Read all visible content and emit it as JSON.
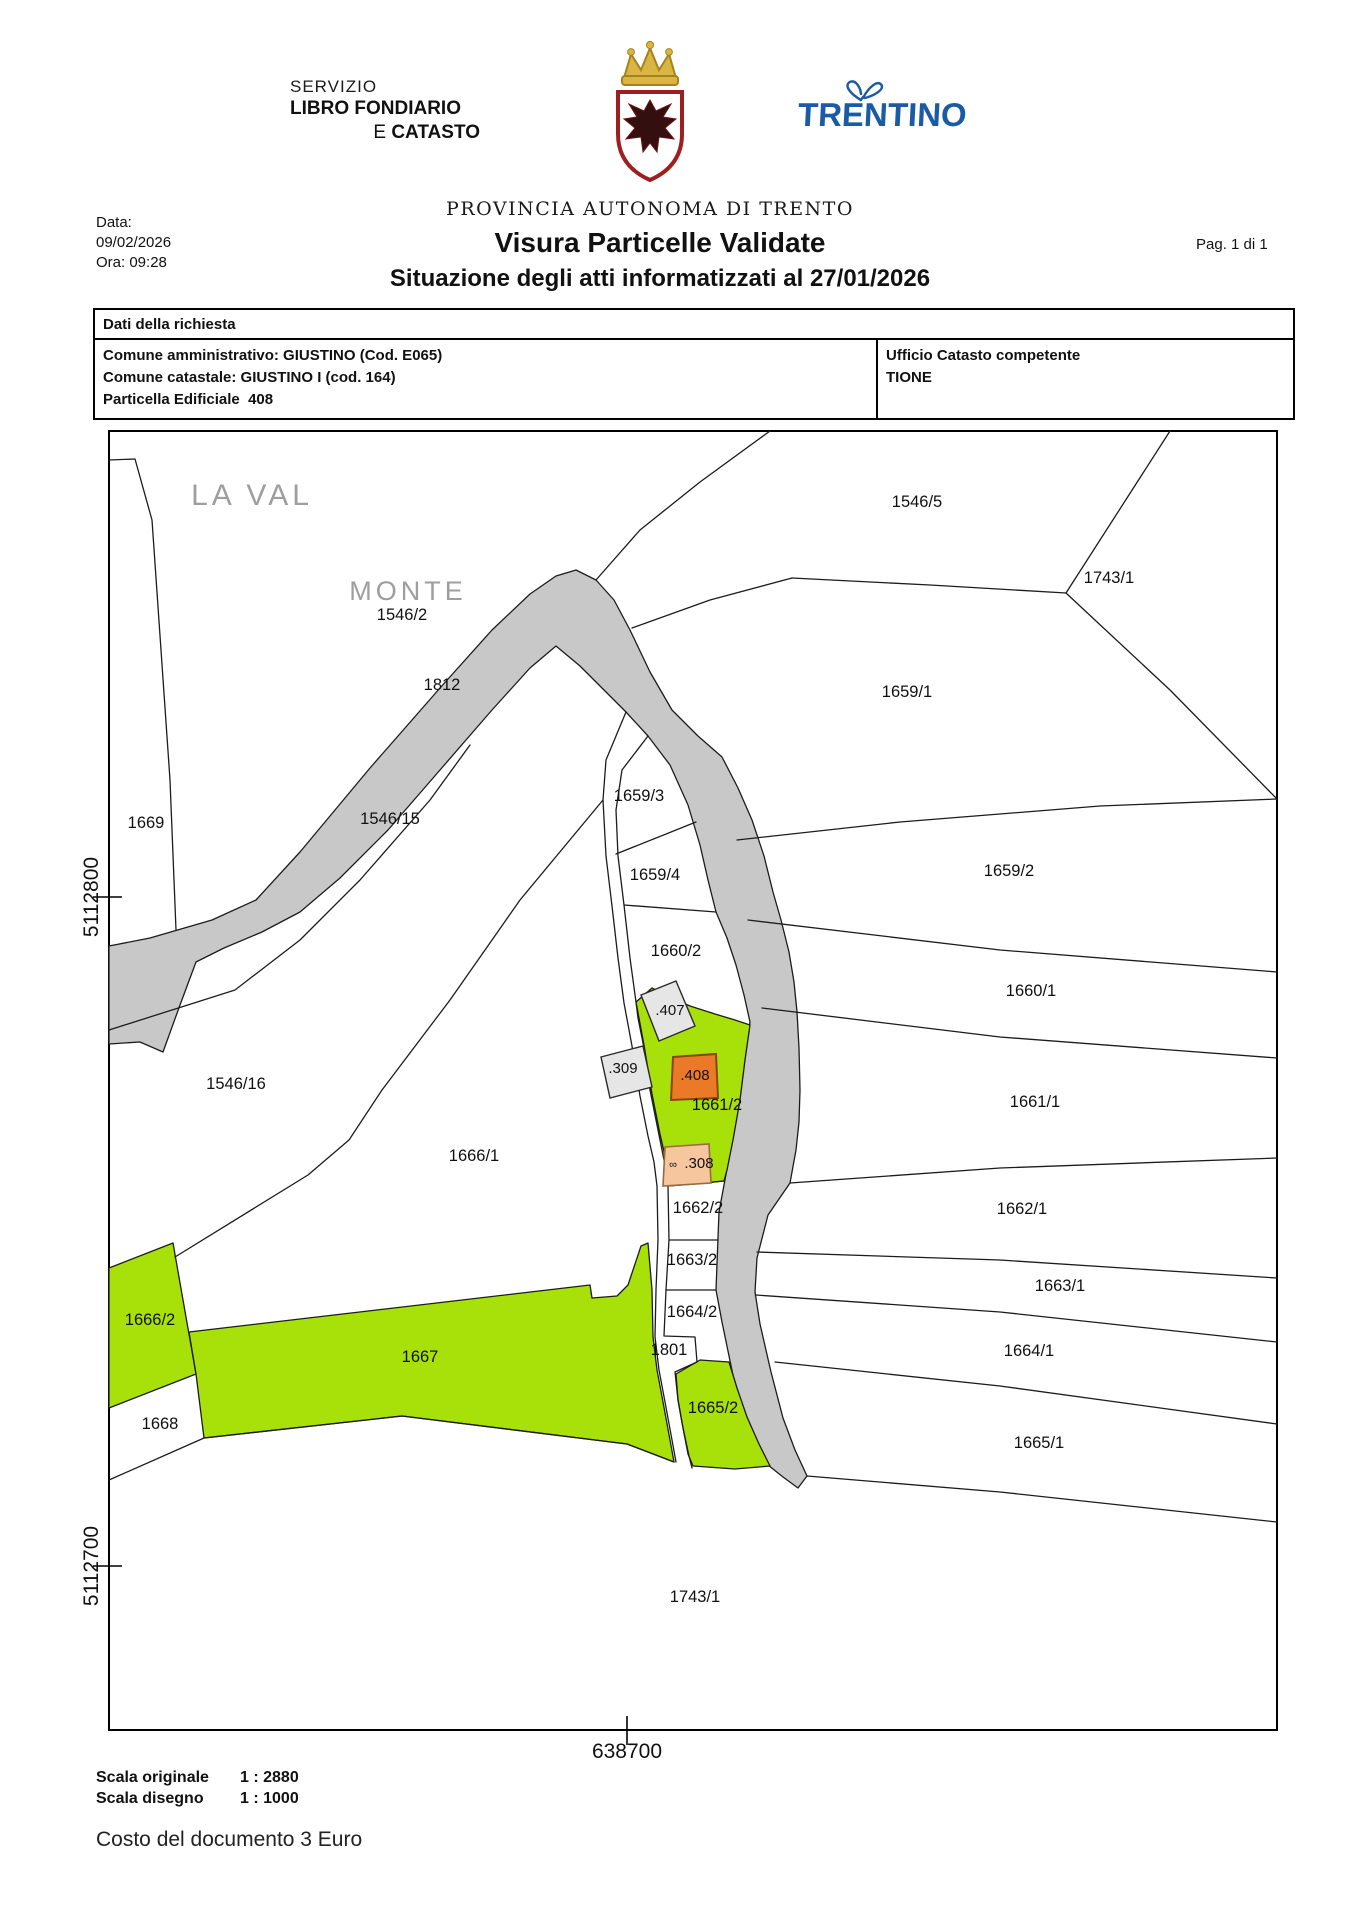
{
  "header": {
    "service_line1": "SERVIZIO",
    "service_line2": "LIBRO FONDIARIO",
    "service_line3_prefix": "E ",
    "service_line3": "CATASTO",
    "province": "PROVINCIA AUTONOMA DI TRENTO",
    "trentino_logo": "TRENTINO",
    "crest_icon": "trento-eagle-crest",
    "butterfly_icon": "butterfly",
    "logo_blue": "#1b5ba6",
    "crest_red": "#9e1f1f",
    "crown_gold": "#d9b544"
  },
  "meta": {
    "date_label": "Data:",
    "date_value": "09/02/2026",
    "time_line": "Ora: 09:28",
    "title": "Visura Particelle Validate",
    "subtitle": "Situazione degli atti informatizzati al 27/01/2026",
    "page": "Pag. 1 di 1"
  },
  "request_table": {
    "header": "Dati della richiesta",
    "rows": [
      "Comune amministrativo: GIUSTINO (Cod. E065)",
      "Comune catastale: GIUSTINO I (cod. 164)",
      "Particella Edificiale  408"
    ],
    "office_label": "Ufficio Catasto competente",
    "office_value": "TIONE"
  },
  "map": {
    "colors": {
      "highlight_green": "#a8e00a",
      "selected_parcel_orange": "#ea7a28",
      "building_gray": "#e6e6e6",
      "building_peach": "#f6c69e",
      "road_gray": "#c8c8c8",
      "toponym_gray": "#9e9e9e"
    },
    "area_labels": [
      {
        "text": "LA VAL",
        "x": 252,
        "y": 505,
        "size": 30
      },
      {
        "text": "MONTE",
        "x": 408,
        "y": 600,
        "size": 27
      }
    ],
    "parcel_labels": [
      {
        "text": "1546/2",
        "x": 402,
        "y": 620
      },
      {
        "text": "1546/5",
        "x": 917,
        "y": 507
      },
      {
        "text": "1743/1",
        "x": 1109,
        "y": 583
      },
      {
        "text": "1659/1",
        "x": 907,
        "y": 697
      },
      {
        "text": "1812",
        "x": 442,
        "y": 690
      },
      {
        "text": "1669",
        "x": 146,
        "y": 828
      },
      {
        "text": "1546/15",
        "x": 390,
        "y": 824
      },
      {
        "text": "1659/3",
        "x": 639,
        "y": 801
      },
      {
        "text": "1659/4",
        "x": 655,
        "y": 880
      },
      {
        "text": "1659/2",
        "x": 1009,
        "y": 876
      },
      {
        "text": "1660/2",
        "x": 676,
        "y": 956
      },
      {
        "text": "1660/1",
        "x": 1031,
        "y": 996
      },
      {
        "text": ".407",
        "x": 670,
        "y": 1015,
        "small": true
      },
      {
        "text": ".309",
        "x": 623,
        "y": 1073,
        "small": true
      },
      {
        "text": ".408",
        "x": 695,
        "y": 1080,
        "small": true
      },
      {
        "text": "1661/2",
        "x": 717,
        "y": 1110
      },
      {
        "text": "1661/1",
        "x": 1035,
        "y": 1107
      },
      {
        "text": "1546/16",
        "x": 236,
        "y": 1089
      },
      {
        "text": "1666/1",
        "x": 474,
        "y": 1161
      },
      {
        "text": ".308",
        "x": 699,
        "y": 1168,
        "small": true
      },
      {
        "text": "1662/2",
        "x": 698,
        "y": 1213
      },
      {
        "text": "1662/1",
        "x": 1022,
        "y": 1214
      },
      {
        "text": "1663/2",
        "x": 692,
        "y": 1265
      },
      {
        "text": "1663/1",
        "x": 1060,
        "y": 1291
      },
      {
        "text": "1664/2",
        "x": 692,
        "y": 1317
      },
      {
        "text": "1664/1",
        "x": 1029,
        "y": 1356
      },
      {
        "text": "1801",
        "x": 669,
        "y": 1355
      },
      {
        "text": "1667",
        "x": 420,
        "y": 1362
      },
      {
        "text": "1666/2",
        "x": 150,
        "y": 1325
      },
      {
        "text": "1665/2",
        "x": 713,
        "y": 1413
      },
      {
        "text": "1668",
        "x": 160,
        "y": 1429
      },
      {
        "text": "1665/1",
        "x": 1039,
        "y": 1448
      },
      {
        "text": "1743/1",
        "x": 695,
        "y": 1602
      }
    ],
    "building_308_symbol": {
      "text": "∞",
      "x": 673,
      "y": 1168
    },
    "axis_left": [
      {
        "label": "5112800",
        "x": 98,
        "y": 897
      },
      {
        "label": "5112700",
        "x": 98,
        "y": 1566
      }
    ],
    "axis_bottom": [
      {
        "label": "638700",
        "x": 627,
        "y": 1758
      }
    ]
  },
  "footer": {
    "scale_original_label": "Scala originale",
    "scale_original_value": "1 : 2880",
    "scale_drawing_label": "Scala disegno",
    "scale_drawing_value": "1 : 1000",
    "cost_line": "Costo del documento 3 Euro"
  }
}
